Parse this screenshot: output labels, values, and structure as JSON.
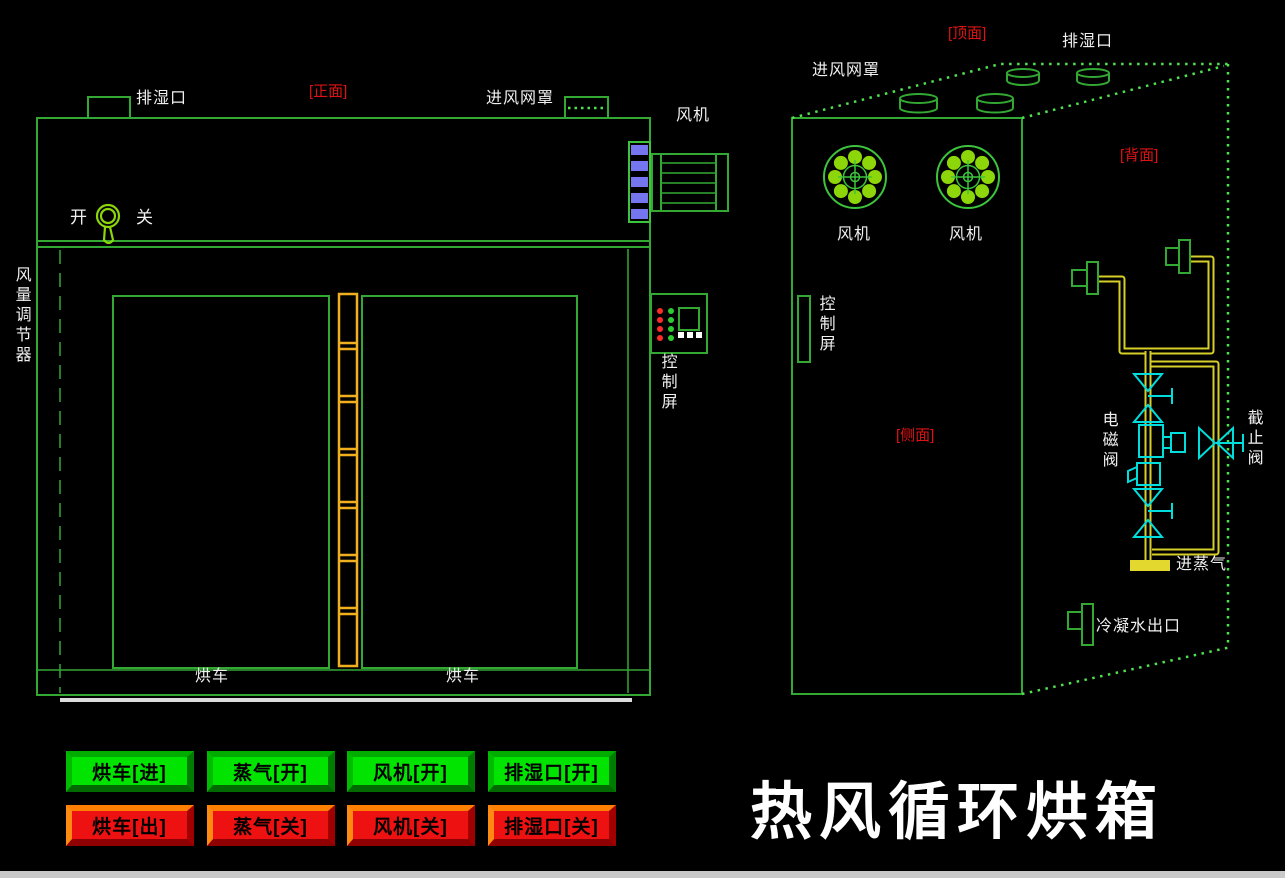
{
  "title": "热风循环烘箱",
  "front_view": {
    "face_tag": "[正面]",
    "moisture_vent": "排湿口",
    "air_inlet_mesh": "进风网罩",
    "fan": "风机",
    "switch_open": "开",
    "switch_close": "关",
    "air_damper": "风量调节器",
    "control_screen": "控制屏",
    "cart_left": "烘车",
    "cart_right": "烘车"
  },
  "side_view": {
    "top_tag": "[顶面]",
    "back_tag": "[背面]",
    "side_tag": "[侧面]",
    "moisture_vent": "排湿口",
    "air_inlet_mesh": "进风网罩",
    "fan_left": "风机",
    "fan_right": "风机",
    "control_screen": "控制屏",
    "solenoid_valve": "电磁阀",
    "stop_valve": "截止阀",
    "steam_inlet": "进蒸气",
    "condensate_outlet": "冷凝水出口"
  },
  "buttons": {
    "row_on": [
      "烘车[进]",
      "蒸气[开]",
      "风机[开]",
      "排湿口[开]"
    ],
    "row_off": [
      "烘车[出]",
      "蒸气[关]",
      "风机[关]",
      "排湿口[关]"
    ]
  },
  "colors": {
    "background": "#000000",
    "line_green": "#33A833",
    "dotted_green": "#4FE24F",
    "fan_blade_green": "#8CD60A",
    "pipe_yellow": "#D6CE28",
    "ladder_yellow": "#EFAF1E",
    "valve_cyan": "#00DDDD",
    "fin_blue": "#7575EF",
    "label_red": "#DE1212",
    "label_white": "#F0F0F0",
    "button_on_green": "#00E400",
    "button_off_red": "#EE1111",
    "button_off_bevel_orange": "#FF7F00"
  }
}
